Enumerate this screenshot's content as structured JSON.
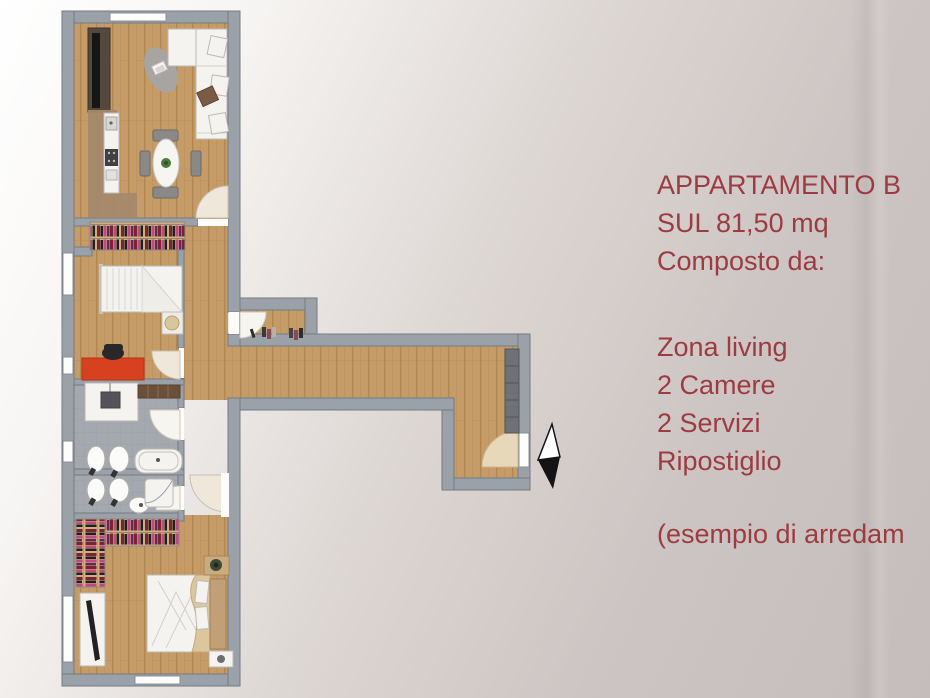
{
  "panel": {
    "title_lines": [
      "APPARTAMENTO B",
      "SUL 81,50 mq",
      "Composto da:"
    ],
    "features": [
      "Zona living",
      "2 Camere",
      "2 Servizi",
      "Ripostiglio"
    ],
    "note": "(esempio di arredam"
  },
  "palette": {
    "bg_start": "#ffffff",
    "bg_mid": "#ddd7d4",
    "bg_end": "#c5bdbb",
    "text": "#9c3b41",
    "wall": "#9aa1a9",
    "wall_edge": "#747a82",
    "wood": "#c59c68",
    "wood_line": "#b2874f",
    "tile": "#a4a8af",
    "tile_line": "#969aa1",
    "white_f": "#f4f3f0",
    "white_f_edge": "#bdbab3",
    "door_arc": "#efe8da",
    "entry_arc": "#e8d8ba",
    "red_desk": "#d7411f",
    "tv_brown": "#55483c",
    "tv_screen": "#161616",
    "kitchen_brown": "#a5886b",
    "cabinet_dark": "#6e7177",
    "clothes_bg": "#cfae7f",
    "clothes_a": "#7a2430",
    "clothes_b": "#5c2a5e",
    "clothes_c": "#c2487e",
    "clothes_d": "#1e1e24",
    "arrow": "#141414"
  }
}
